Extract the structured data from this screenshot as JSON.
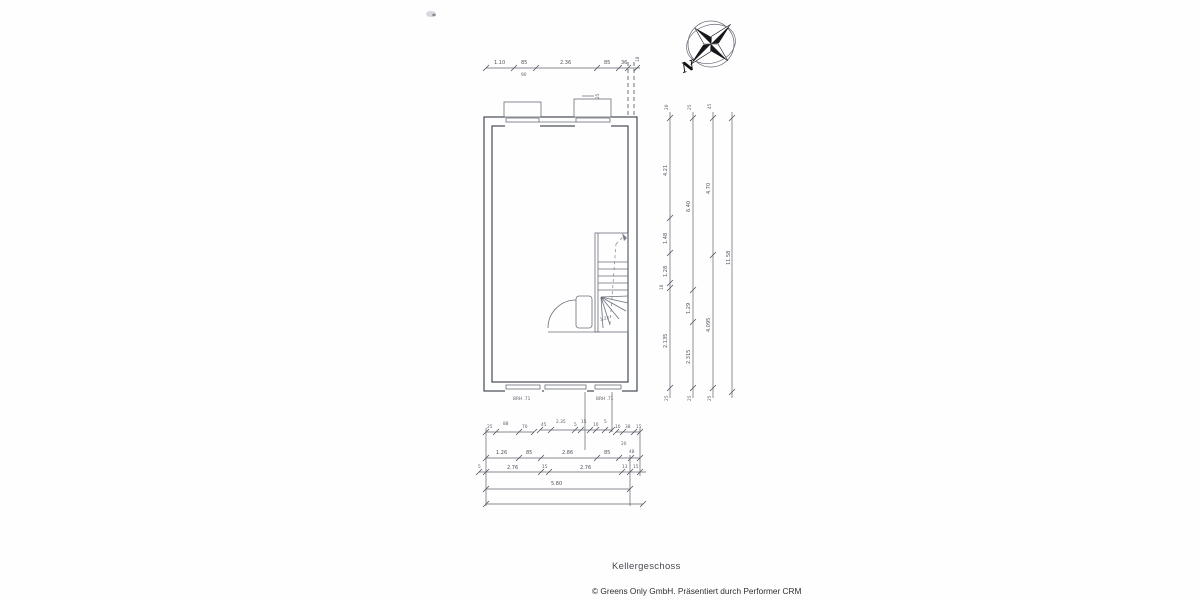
{
  "page": {
    "title": "Kellergeschoss",
    "footer": "© Greens Only GmbH. Präsentiert durch Performer CRM"
  },
  "compass": {
    "label": "N"
  },
  "plan": {
    "brh_left": "BRH .71",
    "brh_right": "BRH .71",
    "stair_label": "1.22",
    "shaft_label": "25"
  },
  "dims": {
    "top": [
      "1.10",
      "85",
      "2.36",
      "85",
      "36"
    ],
    "top_sub": "90",
    "top_end": "18",
    "col1": [
      "20",
      "4.21",
      "1.48",
      "1.28",
      "18",
      "2.135",
      "25"
    ],
    "col2": [
      "25",
      "6.40",
      "1.29",
      "2.315",
      "25"
    ],
    "col3": [
      "45",
      "4.70",
      "4.095",
      "25"
    ],
    "col4": [
      "11.58"
    ],
    "rowA1": [
      "25",
      "88",
      "70"
    ],
    "rowA2": [
      "45",
      "2.35",
      "5",
      "15",
      "10",
      "5"
    ],
    "rowA3": [
      "10",
      "38",
      "15"
    ],
    "rowA_sub": "20",
    "rowB": [
      "1.26",
      "85",
      "2.86",
      "85",
      "48"
    ],
    "rowC": [
      "5",
      "2.76",
      "15",
      "2.76",
      "13",
      "15"
    ],
    "rowD": [
      "5.80"
    ]
  }
}
